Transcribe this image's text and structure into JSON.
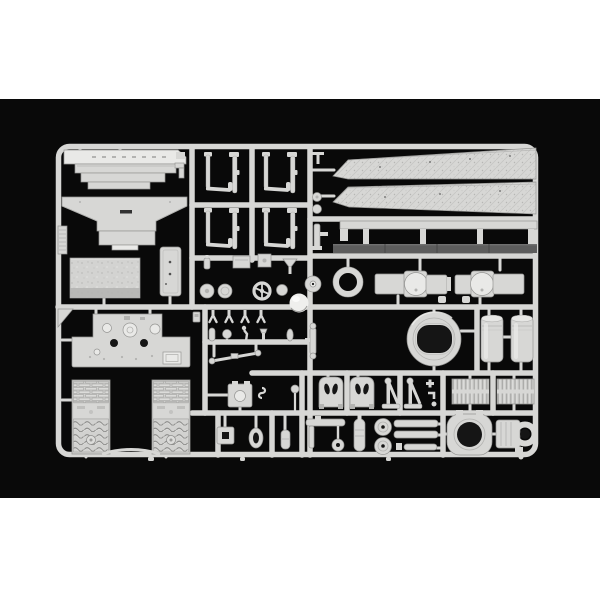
{
  "scene": {
    "type": "product-photograph",
    "description": "Injection-moulded light grey styrene model-kit sprue (parts tree) for an armoured-vehicle kit, photographed on a black studio background with white letterbox bands at the top and bottom",
    "letterbox": {
      "top_height_px": 99,
      "bottom_start_px": 498
    }
  },
  "colors": {
    "page_bg": "#ffffff",
    "photo_bg": "#090909",
    "plastic": "#d7d7d5",
    "plastic_light": "#e9e9e7",
    "plastic_dark": "#b3b3b1",
    "plastic_shadow": "#969694",
    "dark_strip": "#5d5d5d",
    "hole_dark": "#151515",
    "highlight": "#fbfbfa"
  },
  "sprue": {
    "frame": {
      "left": 55,
      "top": 143,
      "right": 539,
      "bottom": 458,
      "corner_radius": 12,
      "bar_width": 7
    },
    "parts": [
      {
        "name": "hull-rear-deck-plate",
        "region": "top-left"
      },
      {
        "name": "glacis-plate",
        "region": "top-left"
      },
      {
        "name": "angle-bracket-small",
        "region": "top-left"
      },
      {
        "name": "ribbed-skirt-strip",
        "region": "left-edge"
      },
      {
        "name": "textured-access-plate",
        "region": "left"
      },
      {
        "name": "hull-door-panel",
        "region": "left-center"
      },
      {
        "name": "torsion-bar-rod-pairs",
        "count": 4,
        "region": "upper-center-grid"
      },
      {
        "name": "fender-tread-strip-upper",
        "region": "top-right"
      },
      {
        "name": "fender-tread-strip-lower",
        "region": "top-right"
      },
      {
        "name": "side-rail-with-posts",
        "region": "right"
      },
      {
        "name": "dark-track-pad-strip",
        "region": "right"
      },
      {
        "name": "idler-ring",
        "region": "center-right"
      },
      {
        "name": "road-wheel-small",
        "region": "center"
      },
      {
        "name": "barrel-coupling-left",
        "region": "center-right"
      },
      {
        "name": "barrel-coupling-right",
        "region": "center-right"
      },
      {
        "name": "ball-dome",
        "region": "center"
      },
      {
        "name": "toolbox-small",
        "region": "center"
      },
      {
        "name": "funnel-fitting",
        "region": "center"
      },
      {
        "name": "disc-wheel-pair",
        "count": 2,
        "region": "center"
      },
      {
        "name": "steering-wheel",
        "region": "center"
      },
      {
        "name": "spring-clamp-set",
        "count": 4,
        "region": "center"
      },
      {
        "name": "small-fittings-row",
        "region": "center"
      },
      {
        "name": "tow-bar-diagonal",
        "region": "center"
      },
      {
        "name": "shock-absorber",
        "region": "center"
      },
      {
        "name": "runner-column-fittings",
        "region": "center-top"
      },
      {
        "name": "corner-gusset",
        "region": "mid-left"
      },
      {
        "name": "engine-deck-plate",
        "region": "lower-left"
      },
      {
        "name": "louvered-grille-panel-left",
        "region": "bottom-left"
      },
      {
        "name": "louvered-grille-panel-right",
        "region": "bottom-left"
      },
      {
        "name": "grille-arc-strip",
        "region": "bottom-left"
      },
      {
        "name": "cupola-ring",
        "region": "lower-center"
      },
      {
        "name": "fuel-drum-pair",
        "count": 2,
        "region": "lower-right"
      },
      {
        "name": "crew-seat-pair",
        "count": 2,
        "region": "bottom-center"
      },
      {
        "name": "jack-stand-pair",
        "count": 2,
        "region": "bottom-center"
      },
      {
        "name": "valve-cluster-small",
        "region": "bottom-center"
      },
      {
        "name": "intake-grille-pair",
        "count": 2,
        "region": "bottom-right"
      },
      {
        "name": "tow-hook-assembly",
        "region": "bottom-center"
      },
      {
        "name": "cylinder-capsule",
        "region": "bottom-center"
      },
      {
        "name": "road-wheel-vertical-pair",
        "count": 2,
        "region": "bottom-center"
      },
      {
        "name": "tow-rod-set",
        "count": 3,
        "region": "bottom-center"
      },
      {
        "name": "octagonal-hatch-ring",
        "region": "bottom-right"
      },
      {
        "name": "winch-drum",
        "region": "bottom-right"
      },
      {
        "name": "square-ring-buckle",
        "region": "bottom-center-left"
      },
      {
        "name": "teardrop-ring",
        "region": "bottom-center-left"
      },
      {
        "name": "capsule-small",
        "region": "bottom-center-left"
      }
    ]
  }
}
